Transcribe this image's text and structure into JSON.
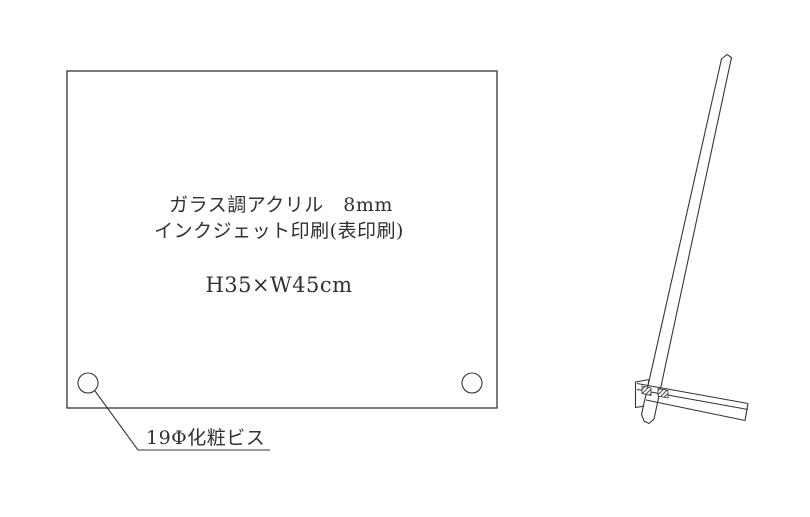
{
  "page": {
    "background": "#ffffff"
  },
  "diagram": {
    "type": "product-spec-technical-drawing",
    "front_view": {
      "material_line1": "ガラス調アクリル　8mm",
      "material_line2": "インクジェット印刷(表印刷)",
      "size_label": "H35×W45cm"
    },
    "callout": {
      "screw_label": "19Φ化粧ビス"
    },
    "colors": {
      "line": "#3a3430",
      "text": "#353029",
      "bg": "#ffffff"
    }
  }
}
